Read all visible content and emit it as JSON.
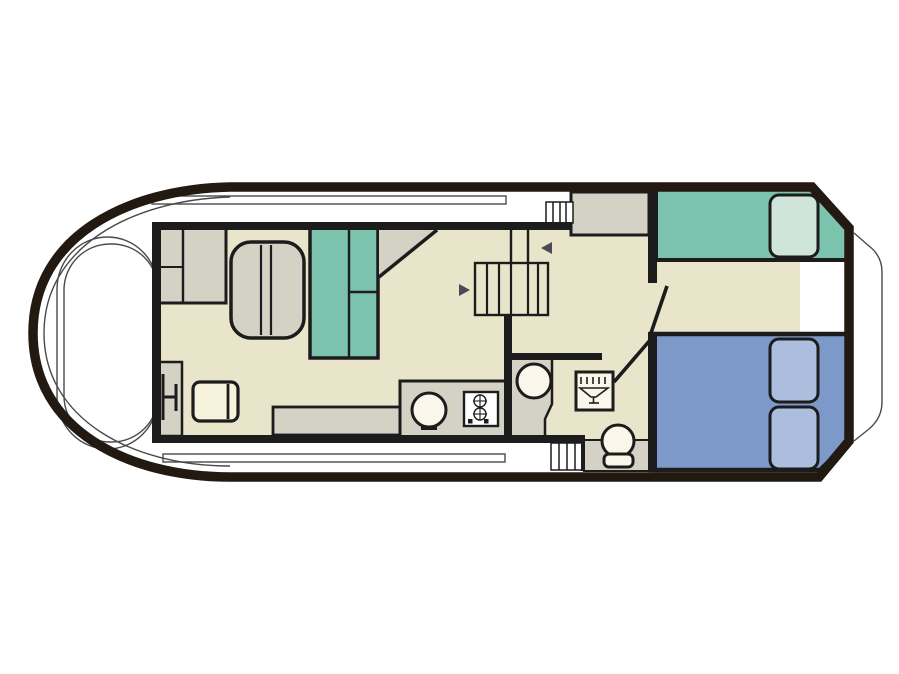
{
  "meta": {
    "type": "boat-floor-plan-diagram",
    "orientation": "bow-left-stern-right",
    "visible_text": []
  },
  "colors": {
    "bg": "#ffffff",
    "ink": "#1c1c1c",
    "hull": "#221911",
    "thin_line": "#4a4a4a",
    "floor": "#e9e5cb",
    "furniture_gray": "#d4d1c5",
    "cream": "#f6f2dc",
    "white_fixture": "#faf7ea",
    "teal": "#7cc3ae",
    "teal_pillow": "#cfe5d9",
    "blue": "#7d99c9",
    "blue_pillow": "#abbedd",
    "arrow": "#4b4b55"
  },
  "diagram": {
    "hull": [
      "thick-outline",
      "bow-rounded-left",
      "stern-angled-right",
      "swim-platform-contour"
    ],
    "decks": [
      "bow-cockpit-with-coaming",
      "top-side-deck-with-rail",
      "bottom-side-deck-with-rail",
      "deck-steps-top",
      "deck-steps-bottom",
      "deck-locker"
    ],
    "saloon": [
      "wardrobe-cabinet",
      "dinette-table",
      "dinette-bench-teal",
      "corner-shelf-triangle",
      "helm-console",
      "helm-seat-glyph",
      "chair",
      "side-bench",
      "galley-counter",
      "galley-sink",
      "galley-stove"
    ],
    "companionway": [
      "stair-rails",
      "stair-treads",
      "direction-arrow-left",
      "direction-arrow-right"
    ],
    "bathroom": [
      "basin-pedestal",
      "wash-basin",
      "shower-tray",
      "shower-icon",
      "toilet-platform",
      "toilet"
    ],
    "aft_cabin": [
      "single-bed-teal",
      "teal-pillow",
      "double-bed-blue",
      "blue-pillow-1",
      "blue-pillow-2",
      "cabin-door",
      "bathroom-door"
    ]
  }
}
